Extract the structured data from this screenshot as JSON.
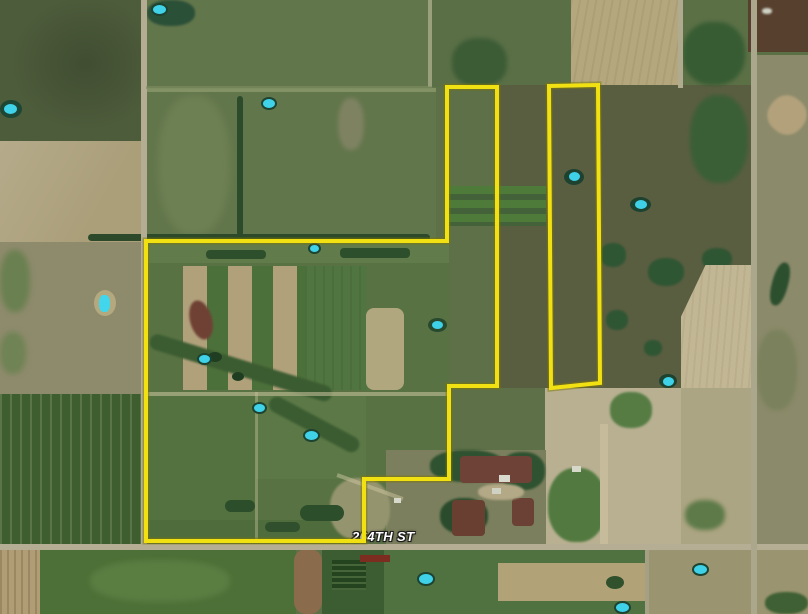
{
  "map": {
    "view": "satellite",
    "road_label": "264TH ST",
    "boundary": {
      "color": "#f2e112",
      "halo_color": "#7e7605",
      "main_parcel_points": "146,241 447,241 447,87 497,87 497,386 449,386 449,479 364,479 364,541 146,541",
      "east_strip_points": "549,86 598,85 600,383 551,388"
    }
  }
}
